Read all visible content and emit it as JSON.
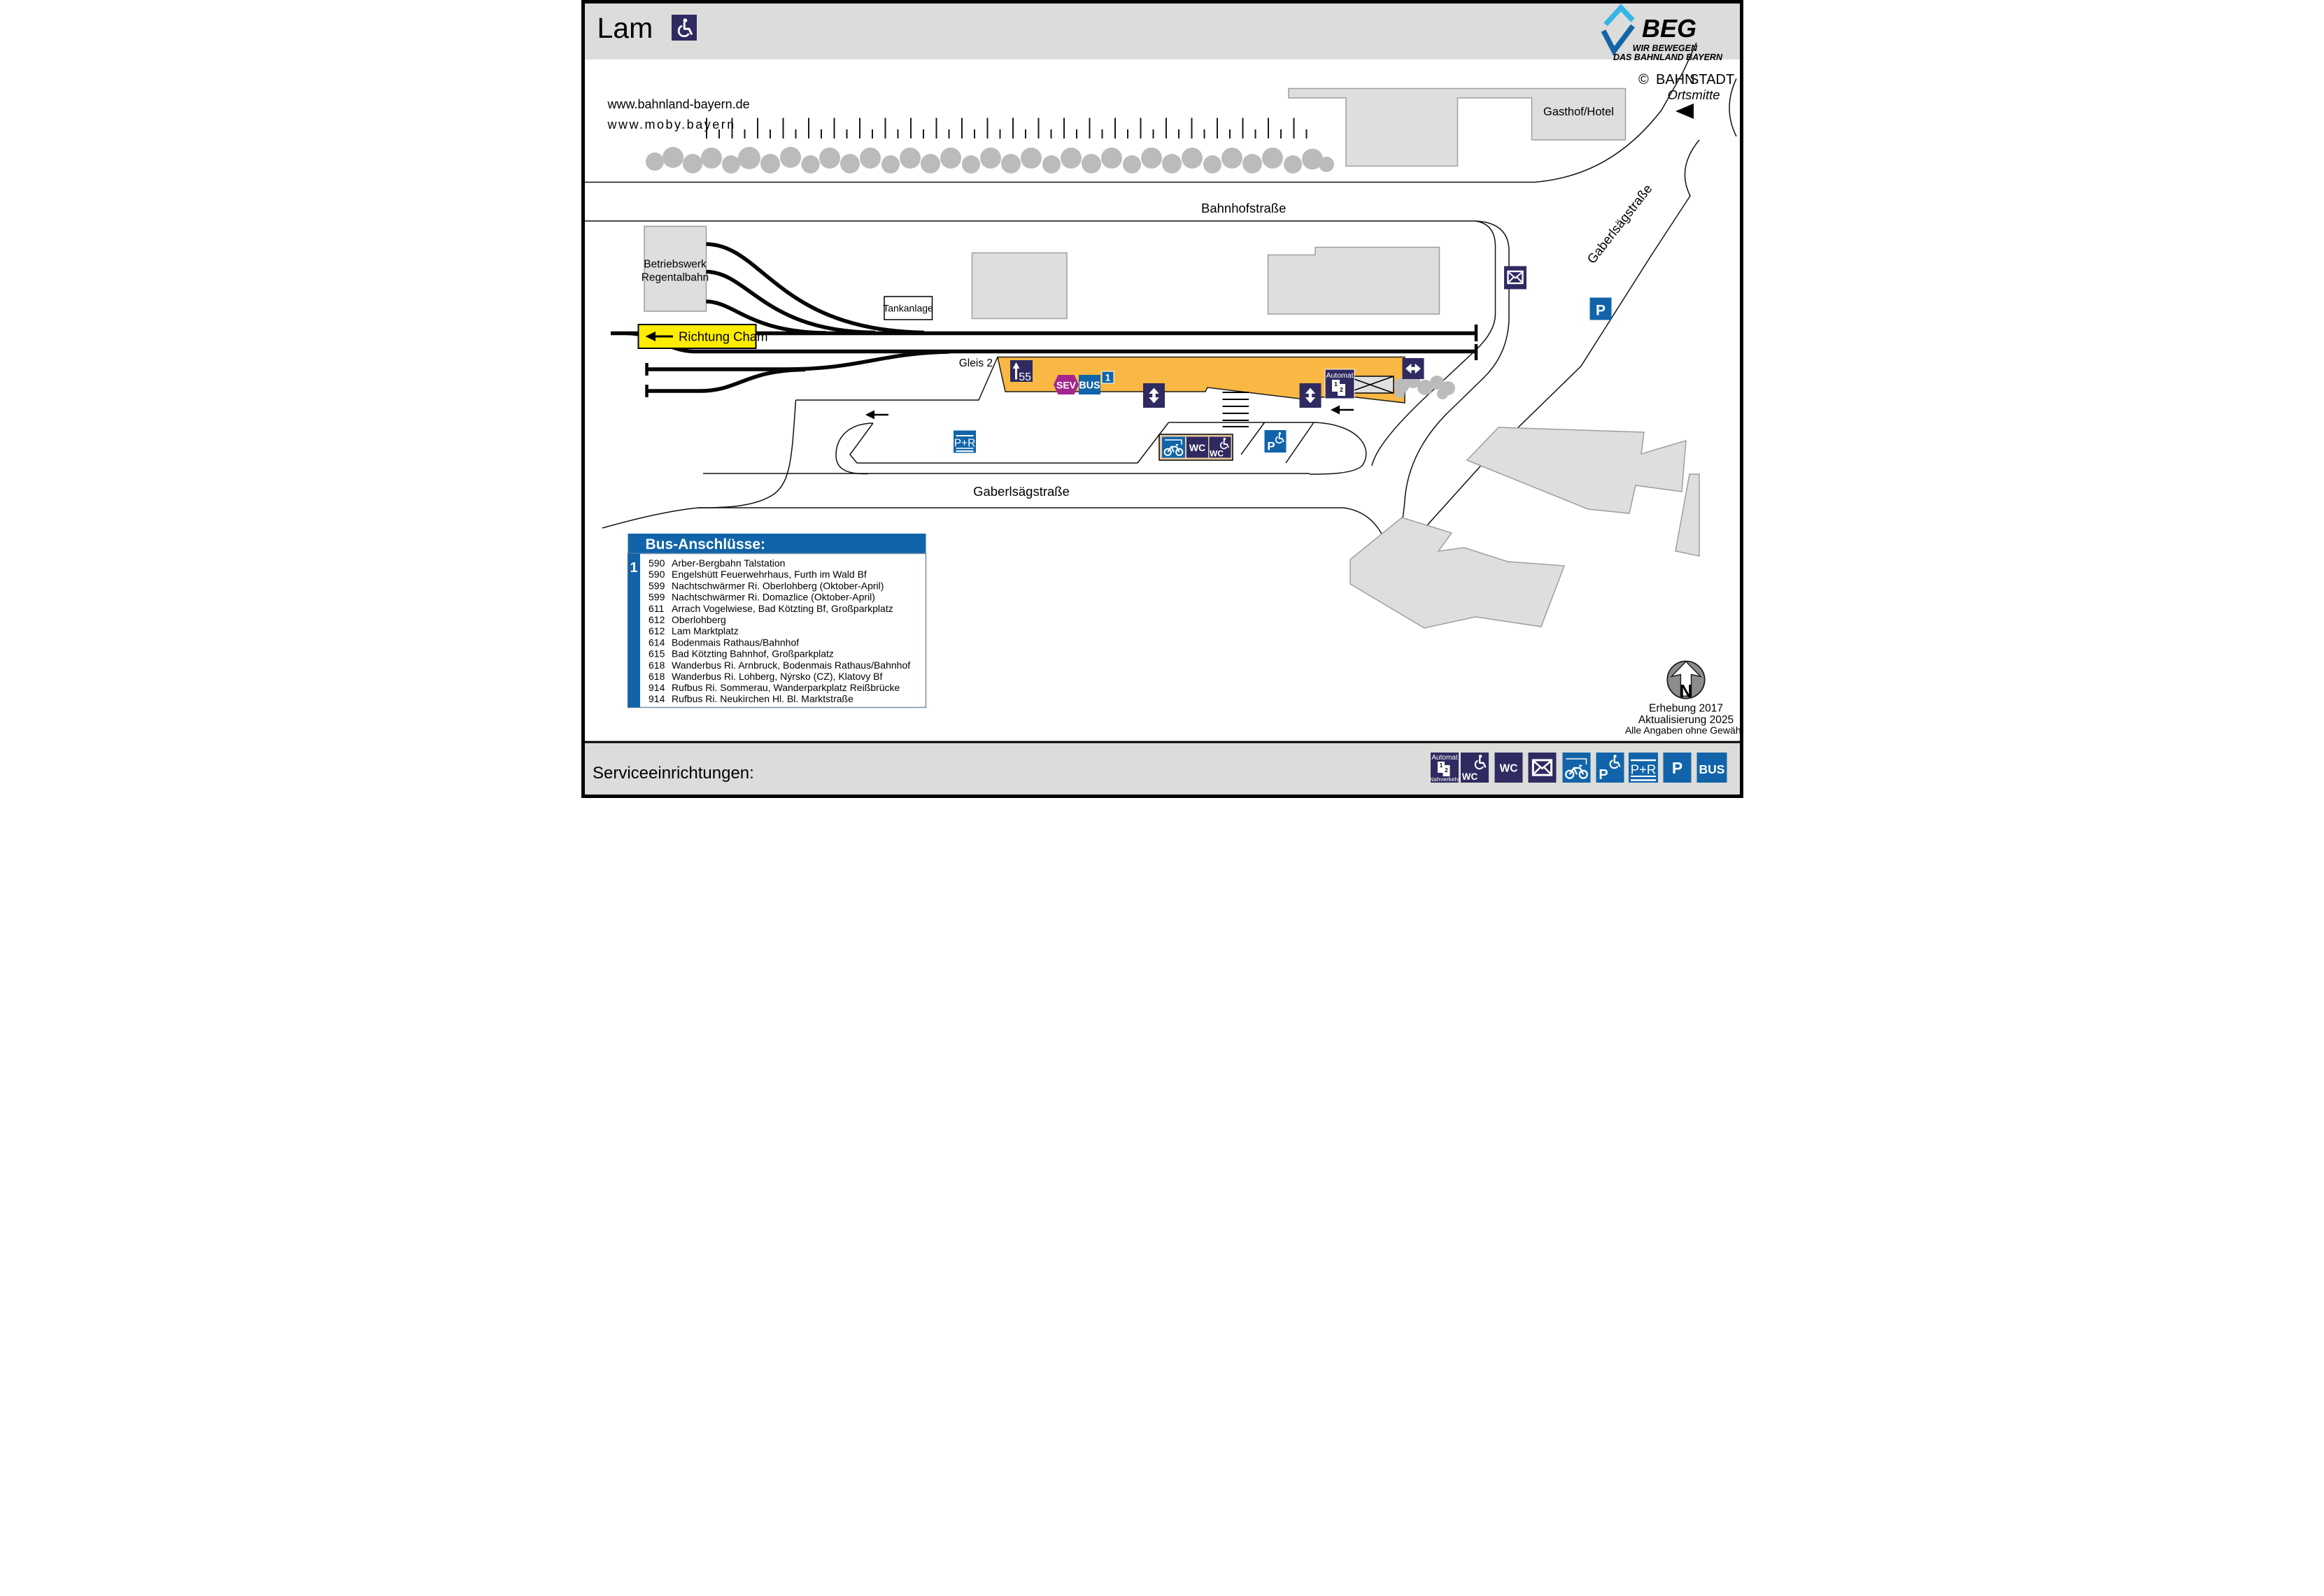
{
  "header": {
    "station": "Lam",
    "link1": "www.bahnland-bayern.de",
    "link2": "www.moby.bayern"
  },
  "branding": {
    "logo": "BEG",
    "claim1": "WIR BEWEGEN",
    "claim2": "DAS BAHNLAND BAYERN",
    "copyright": "©",
    "name_part1": "BAHN",
    "name_part2": "STADT",
    "colors": {
      "beg_dark": "#1465A5",
      "beg_light": "#35B5E8",
      "stadt_green": "#7E9D15",
      "bahn_gray": "#9A9A9A"
    }
  },
  "map": {
    "ortsmitte": "Ortsmitte",
    "bahnhofstrasse": "Bahnhofstraße",
    "gaberlsaegstrasse": "Gaberlsägstraße",
    "gasthof": "Gasthof/Hotel",
    "betriebswerk_line1": "Betriebswerk",
    "betriebswerk_line2": "Regentalbahn",
    "tankanlage": "Tankanlage",
    "richtung_cham": "Richtung Cham",
    "gleis2": "Gleis 2",
    "platform_height": "55",
    "sev": "SEV",
    "bus": "BUS",
    "bus_stop_no": "1",
    "colors": {
      "platform_orange": "#F9B843",
      "sign_yellow": "#FFED00",
      "sev_purple": "#A3268E",
      "shelter_tan": "#E9C9A0"
    }
  },
  "icons": {
    "automat": "Automat",
    "nahverkehr": "Nahverkehr",
    "wc": "WC",
    "p": "P",
    "pr": "P+R",
    "bus": "BUS",
    "digit1": "1",
    "digit2": "2"
  },
  "busBox": {
    "header": "Bus-Anschlüsse:",
    "stop_no": "1",
    "items": [
      {
        "line": "590",
        "dest": "Arber-Bergbahn Talstation"
      },
      {
        "line": "590",
        "dest": "Engelshütt Feuerwehrhaus, Furth im Wald Bf"
      },
      {
        "line": "599",
        "dest": "Nachtschwärmer Ri. Oberlohberg (Oktober-April)"
      },
      {
        "line": "599",
        "dest": "Nachtschwärmer Ri. Domazlice (Oktober-April)"
      },
      {
        "line": "611",
        "dest": "Arrach Vogelwiese, Bad Kötzting Bf, Großparkplatz"
      },
      {
        "line": "612",
        "dest": "Oberlohberg"
      },
      {
        "line": "612",
        "dest": "Lam Marktplatz"
      },
      {
        "line": "614",
        "dest": "Bodenmais Rathaus/Bahnhof"
      },
      {
        "line": "615",
        "dest": "Bad Kötzting Bahnhof, Großparkplatz"
      },
      {
        "line": "618",
        "dest": "Wanderbus Ri. Arnbruck, Bodenmais Rathaus/Bahnhof"
      },
      {
        "line": "618",
        "dest": "Wanderbus Ri. Lohberg, Nýrsko (CZ), Klatovy Bf"
      },
      {
        "line": "914",
        "dest": "Rufbus Ri. Sommerau, Wanderparkplatz Reißbrücke"
      },
      {
        "line": "914",
        "dest": "Rufbus Ri. Neukirchen Hl. Bl. Marktstraße"
      }
    ]
  },
  "legendNote": {
    "north": "N",
    "line1": "Erhebung 2017",
    "line2": "Aktualisierung 2025",
    "line3": "Alle Angaben ohne Gewähr!"
  },
  "footer": {
    "heading": "Serviceeinrichtungen:"
  }
}
